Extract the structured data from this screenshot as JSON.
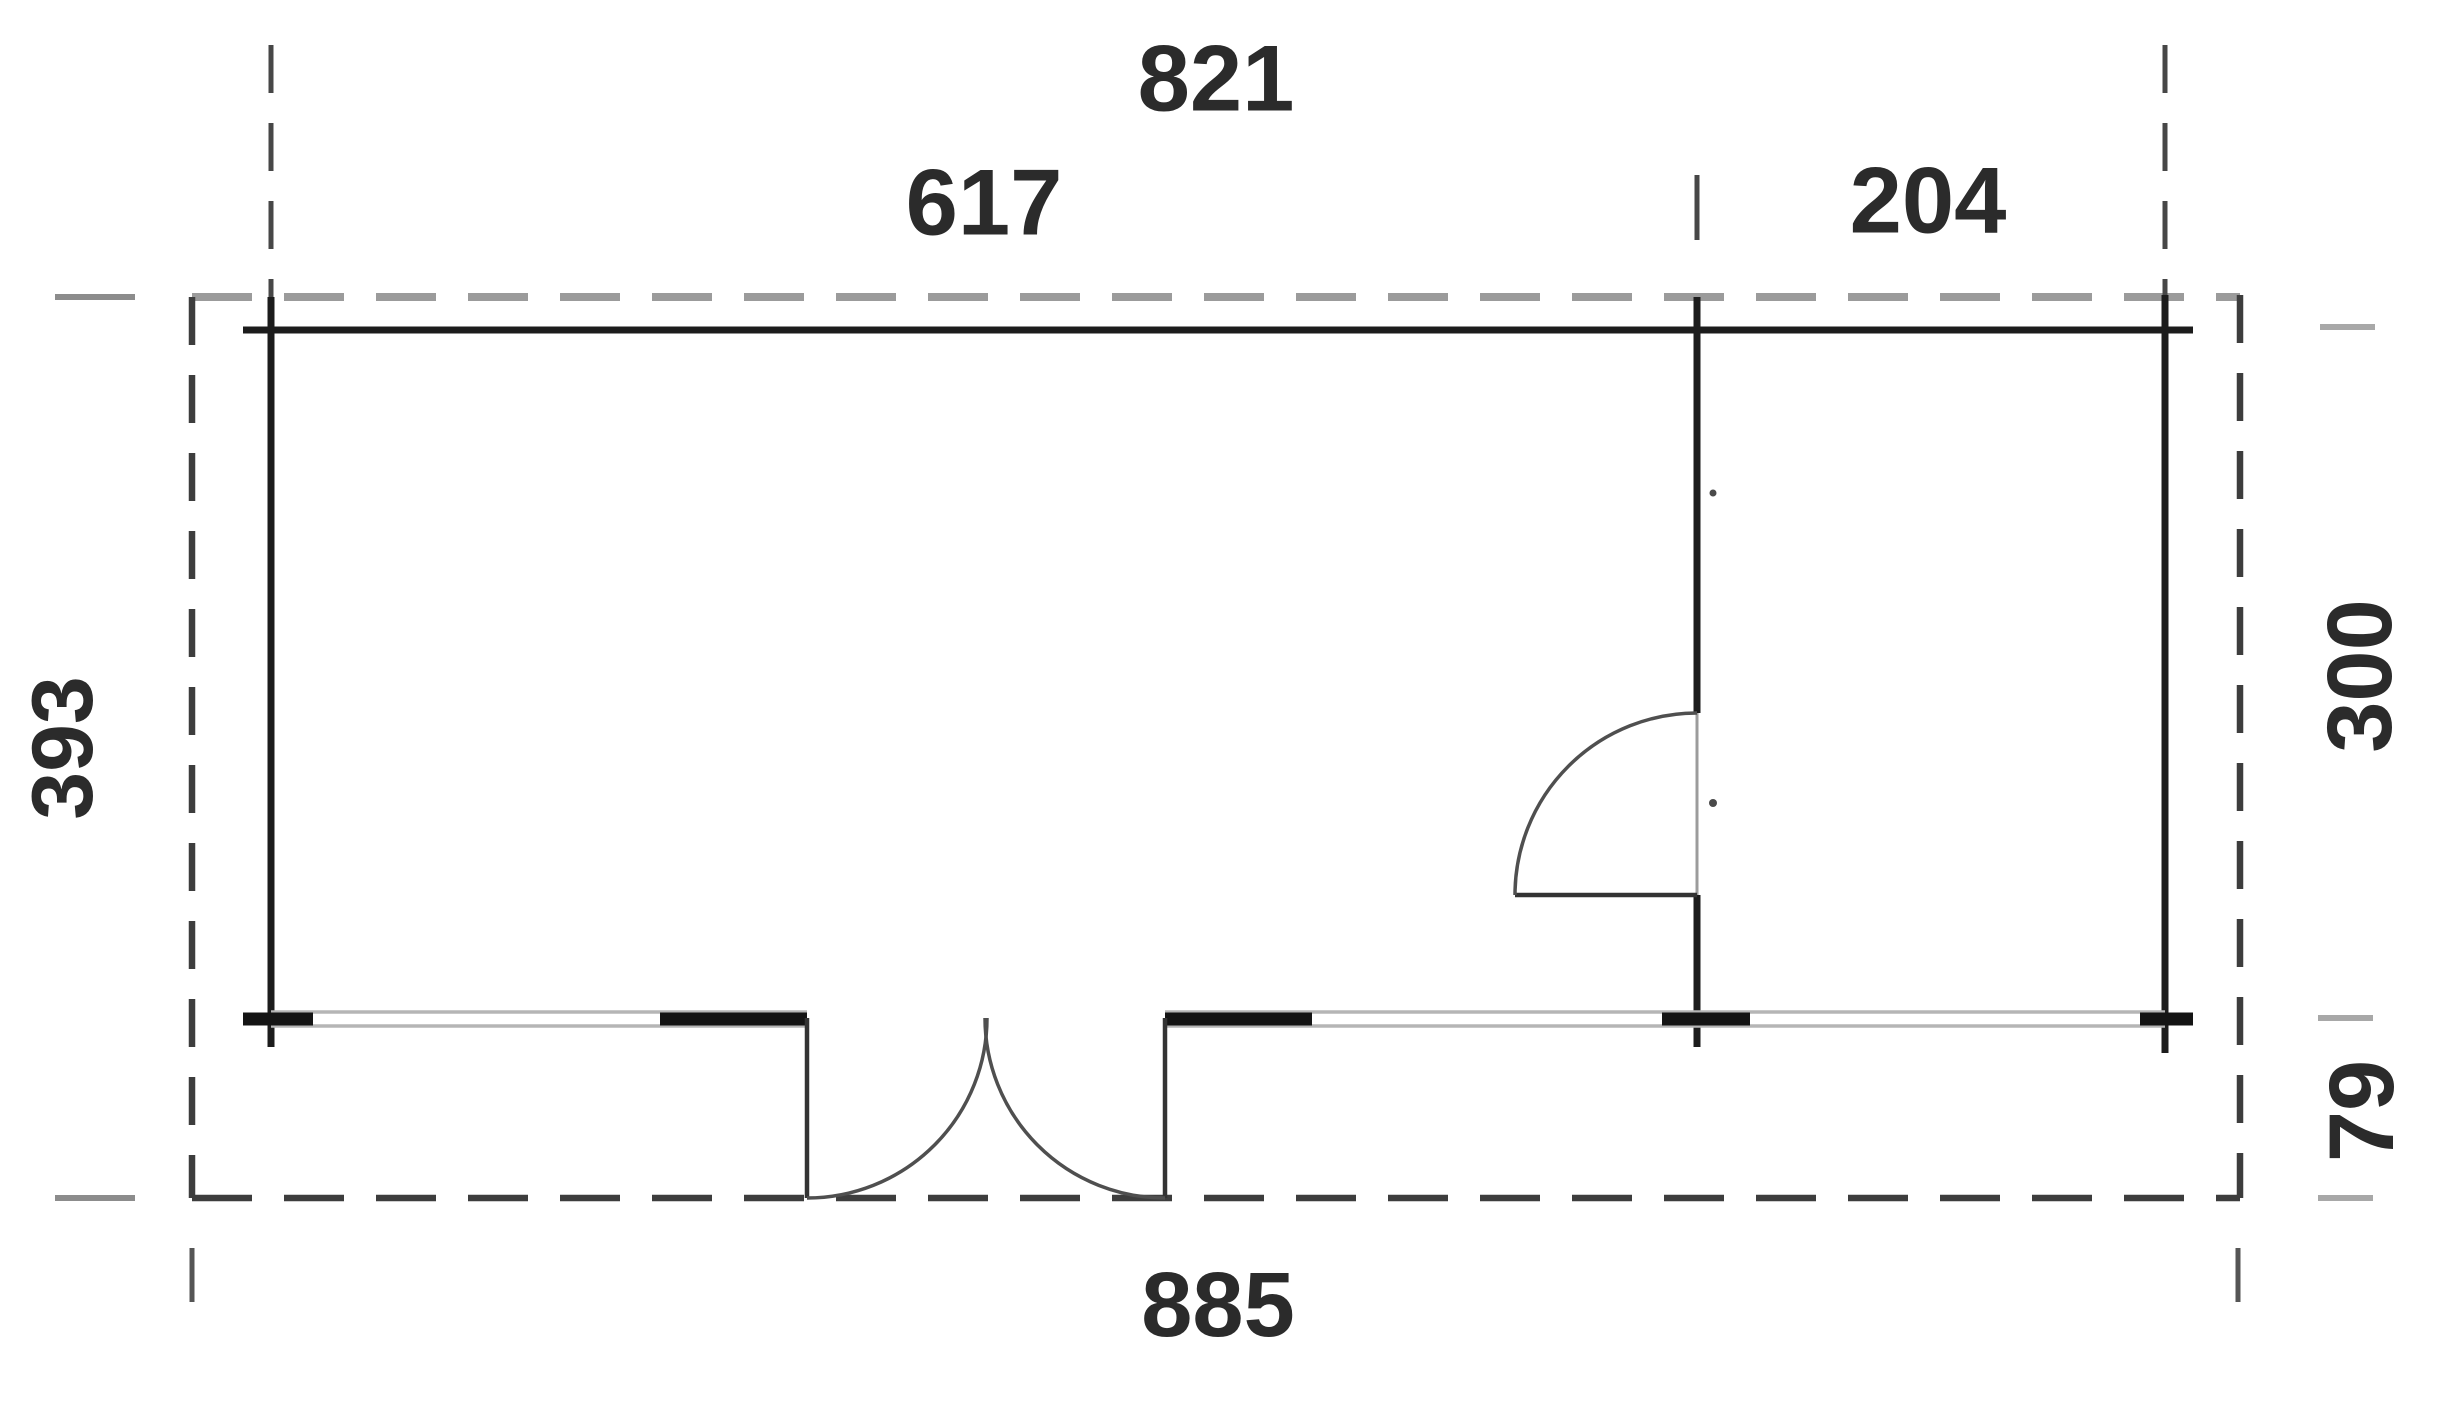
{
  "drawing": {
    "kind": "floor-plan",
    "units_shown": "none (numeric labels only)"
  },
  "dimensions": {
    "top_total": "821",
    "top_left_room": "617",
    "top_right_room": "204",
    "left_overall_depth": "393",
    "right_main_depth": "300",
    "right_porch_depth": "79",
    "bottom_total": "885"
  },
  "colors": {
    "background": "#ffffff",
    "wall": "#1c1c1c",
    "wall_bold_segment": "#141414",
    "overhang_dash_dark": "#3d3d3d",
    "overhang_dash_light": "#9b9b9b",
    "glazing_gray": "#b5b5b5",
    "extension_line": "#474747",
    "tick_gray_left": "#8c8c8c",
    "tick_gray_right": "#a8a8a8",
    "door_swing": "#4f4f4f",
    "door_leaf": "#333333",
    "label_text": "#2b2b2b"
  }
}
